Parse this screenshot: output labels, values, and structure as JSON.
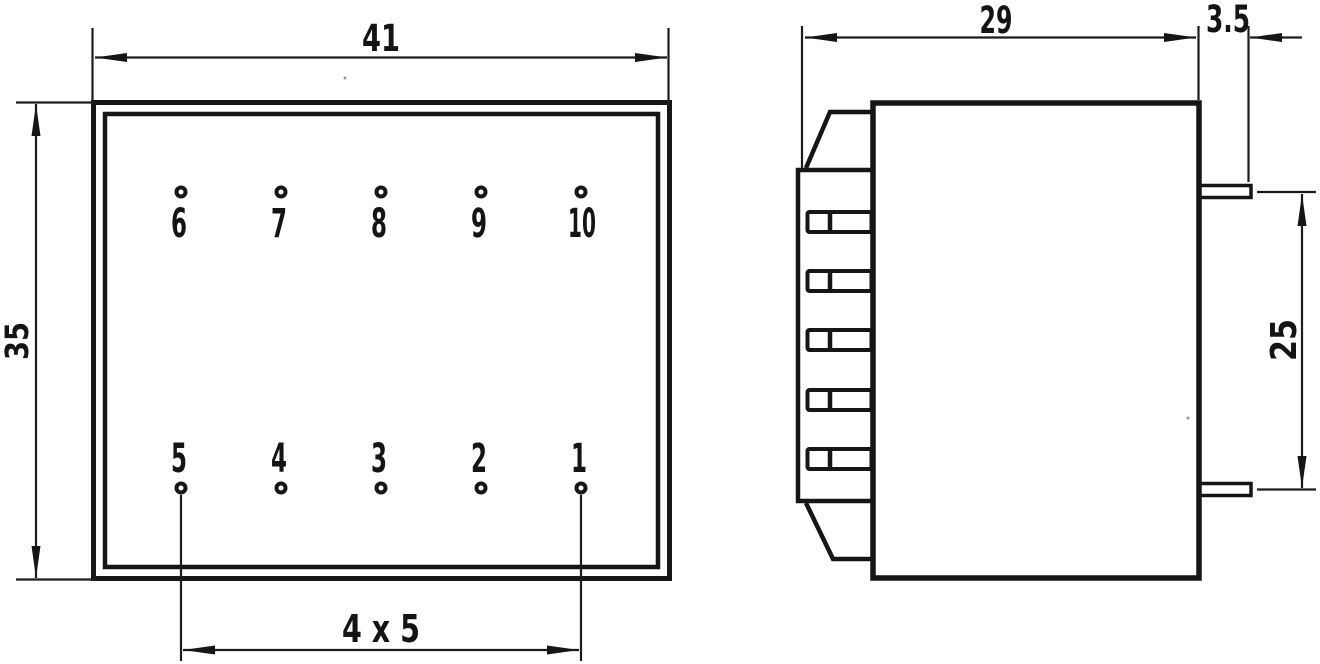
{
  "colors": {
    "line": "#161616",
    "background": "#ffffff"
  },
  "front_view": {
    "width_dim": "41",
    "height_dim": "35",
    "pin_pitch_dim": "4 x 5",
    "top_pins": [
      "6",
      "7",
      "8",
      "9",
      "10"
    ],
    "bottom_pins": [
      "5",
      "4",
      "3",
      "2",
      "1"
    ]
  },
  "side_view": {
    "depth_dim": "29",
    "pin_length_dim": "3.5",
    "pin_span_dim": "25"
  }
}
